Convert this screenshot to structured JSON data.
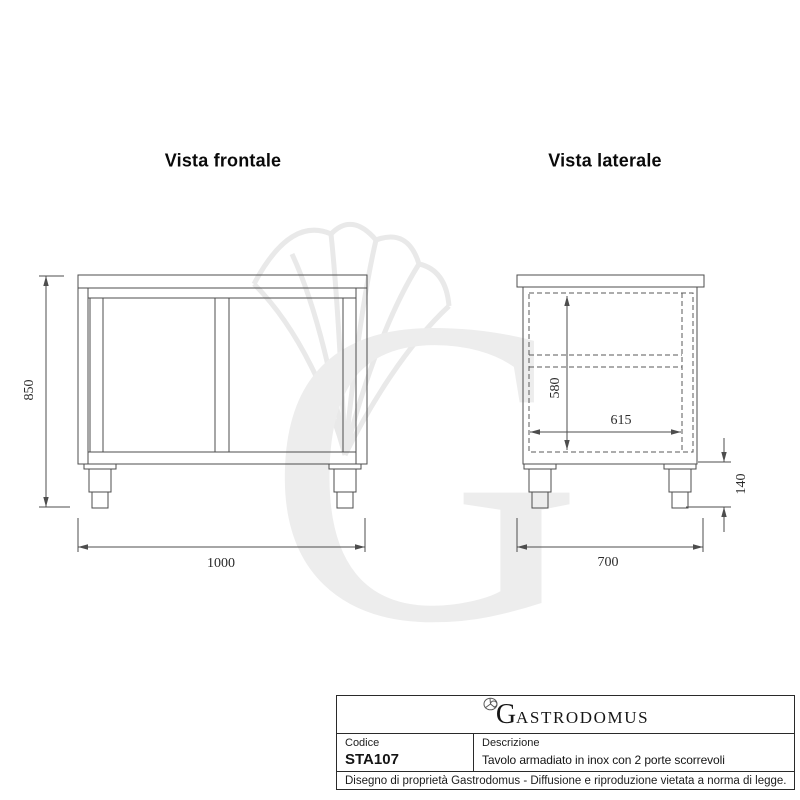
{
  "front_view": {
    "title": "Vista frontale",
    "dim_height": "850",
    "dim_width": "1000"
  },
  "side_view": {
    "title": "Vista laterale",
    "dim_inner_height": "580",
    "dim_inner_depth": "615",
    "dim_leg_height": "140",
    "dim_depth": "700"
  },
  "title_block": {
    "brand_initial": "G",
    "brand_rest": "ASTRODOMUS",
    "code_label": "Codice",
    "code_value": "STA107",
    "description_label": "Descrizione",
    "description_value": "Tavolo armadiato in inox con 2 porte scorrevoli",
    "legal_notice": "Disegno di proprietà Gastrodomus - Diffusione e riproduzione vietata a norma di legge."
  },
  "watermark": {
    "letter": "G"
  },
  "colors": {
    "line": "#4d4d4d",
    "text": "#141414",
    "watermark": "#ededed"
  }
}
